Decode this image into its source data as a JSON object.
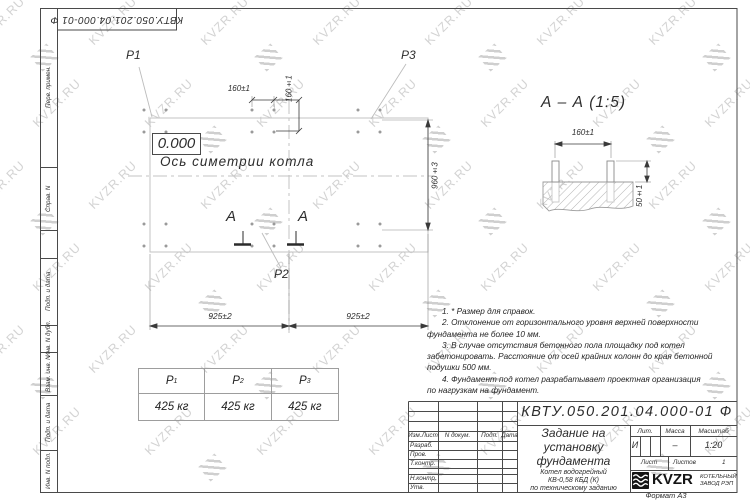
{
  "page": {
    "watermark_text": "KVZR.RU"
  },
  "top_stamp": {
    "doc_number": "КВТУ.050.201.04.000-01 Ф"
  },
  "margin": {
    "perv_primen": "Перв. примен.",
    "sprav_n": "Справ. N",
    "podp_data_1": "Подп. и дата",
    "inv_n_dubl": "Инв. N дубл.",
    "vzam_inv_n": "Взам. инв. N",
    "podp_data_2": "Подп. и дата",
    "inv_n_podl": "Инв. N подл."
  },
  "plan": {
    "p1": "P1",
    "p2": "P2",
    "p3": "P3",
    "level_mark": "0.000",
    "axis_label": "Ось симетрии котла",
    "dim_bolt_h": "160±1",
    "dim_bolt_v": "160±1",
    "dim_height": "960±3",
    "dim_left": "925±2",
    "dim_right": "925±2",
    "section_letter_left": "А",
    "section_letter_right": "А"
  },
  "section_view": {
    "title": "А – А (1:5)",
    "dim_spacing": "160±1",
    "dim_protrusion": "50±1"
  },
  "notes": {
    "lines": [
      {
        "t": "1. * Размер для справок."
      },
      {
        "t": "2. Отклонение от горизонтального уровня верхней поверхности"
      },
      {
        "t": "фундамента не более 10 мм."
      },
      {
        "t": "3. В случае отсутствия бетонного пола площадку под котел"
      },
      {
        "t": "забетонировать. Расстояние от осей крайних колонн до края бетонной"
      },
      {
        "t": "подушки 500 мм."
      },
      {
        "t": "4. Фундамент под котел разрабатывает проектная организация"
      },
      {
        "t": "по нагрузкам на фундамент."
      }
    ]
  },
  "load_table": {
    "columns": [
      {
        "label": "P",
        "sub": "1",
        "value": "425 кг"
      },
      {
        "label": "P",
        "sub": "2",
        "value": "425 кг"
      },
      {
        "label": "P",
        "sub": "3",
        "value": "425 кг"
      }
    ]
  },
  "title_block": {
    "doc_number": "КВТУ.050.201.04.000-01 Ф",
    "title_line1": "Задание на",
    "title_line2": "установку",
    "title_line3": "фундамента",
    "product_line1": "Котел водогрейный",
    "product_line2": "КВ-0,58 КБД (К)",
    "product_line3": "по техническому заданию",
    "col_izm": "Изм.Лист",
    "col_doc": "N докум.",
    "col_podp": "Подп.",
    "col_data": "Дата",
    "row_razrab": "Разраб.",
    "row_prov": "Пров.",
    "row_tkontr": "Т.контр.",
    "row_nkontr": "Н.контр.",
    "row_utv": "Утв.",
    "lit_label": "Лит.",
    "lit_value": "И",
    "massa_label": "Масса",
    "massa_value": "–",
    "masshtab_label": "Масштаб",
    "masshtab_value": "1:20",
    "list_label": "Лист",
    "listov_label": "Листов",
    "listov_value": "1",
    "logo_text": "KVZR",
    "company_line1": "КОТЕЛЬНЫЙ",
    "company_line2": "ЗАВОД РЭП",
    "format_label": "Формат А3"
  }
}
